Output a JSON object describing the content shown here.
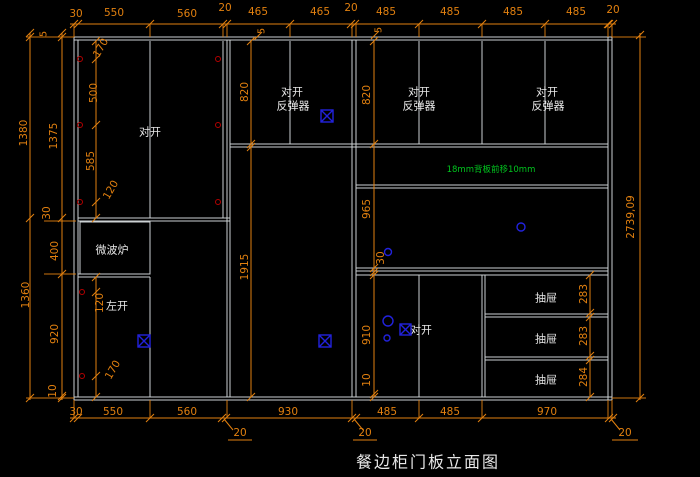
{
  "colors": {
    "bg": "#000000",
    "line": "#ccd1d3",
    "text": "#e8e8e8",
    "dim": "#e2800f",
    "green": "#00c61e",
    "blue": "#2222dd",
    "red": "#b40000"
  },
  "title": "餐边柜门板立面图",
  "dims_top": [
    "30",
    "550",
    "560",
    "20",
    "465",
    "465",
    "20",
    "485",
    "485",
    "485",
    "485",
    "20"
  ],
  "dims_top_reveal": [
    "5",
    "5"
  ],
  "dims_bottom": [
    "30",
    "550",
    "560",
    "930",
    "485",
    "485",
    "970"
  ],
  "dims_bottom_gaps": [
    "20",
    "20",
    "20"
  ],
  "dims_left_outer": [
    "5",
    "1380",
    "1360"
  ],
  "dims_left_inner": [
    "1375",
    "30",
    "400",
    "920",
    "10"
  ],
  "dims_hinge_upper": [
    "170",
    "500",
    "585",
    "120"
  ],
  "dims_hinge_lower": [
    "120",
    "170"
  ],
  "dims_mid": [
    "820",
    "1915"
  ],
  "dims_right": [
    "820",
    "965",
    "30",
    "910",
    "10"
  ],
  "dims_drawer": [
    "283",
    "283",
    "284"
  ],
  "dim_total_height": "2739,09",
  "labels": {
    "pair_open": "对开",
    "rebounder": "反弹器",
    "microwave": "微波炉",
    "left_open": "左开",
    "drawer": "抽屉",
    "note": "18mm背板前移10mm"
  }
}
